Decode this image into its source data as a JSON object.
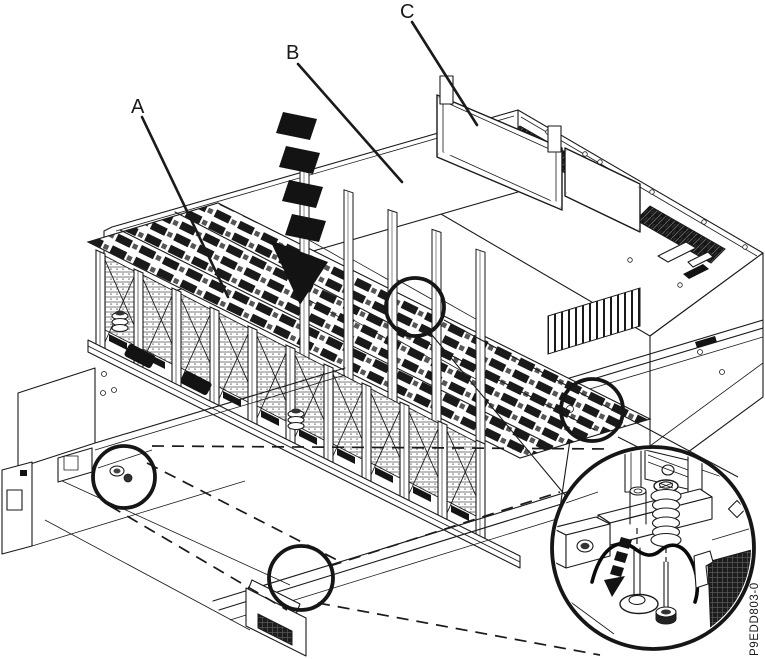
{
  "figure": {
    "type": "technical-illustration",
    "description": "Isometric line drawing of a server system drawer being lowered into a rack chassis, with detail circles and a magnified fastener inset",
    "part_number": "P9EDD803-0",
    "callouts": [
      {
        "label": "A"
      },
      {
        "label": "B"
      },
      {
        "label": "C"
      }
    ],
    "colors": {
      "line": "#1a1a1a",
      "background": "#ffffff",
      "arrow_fill": "#131313"
    }
  }
}
